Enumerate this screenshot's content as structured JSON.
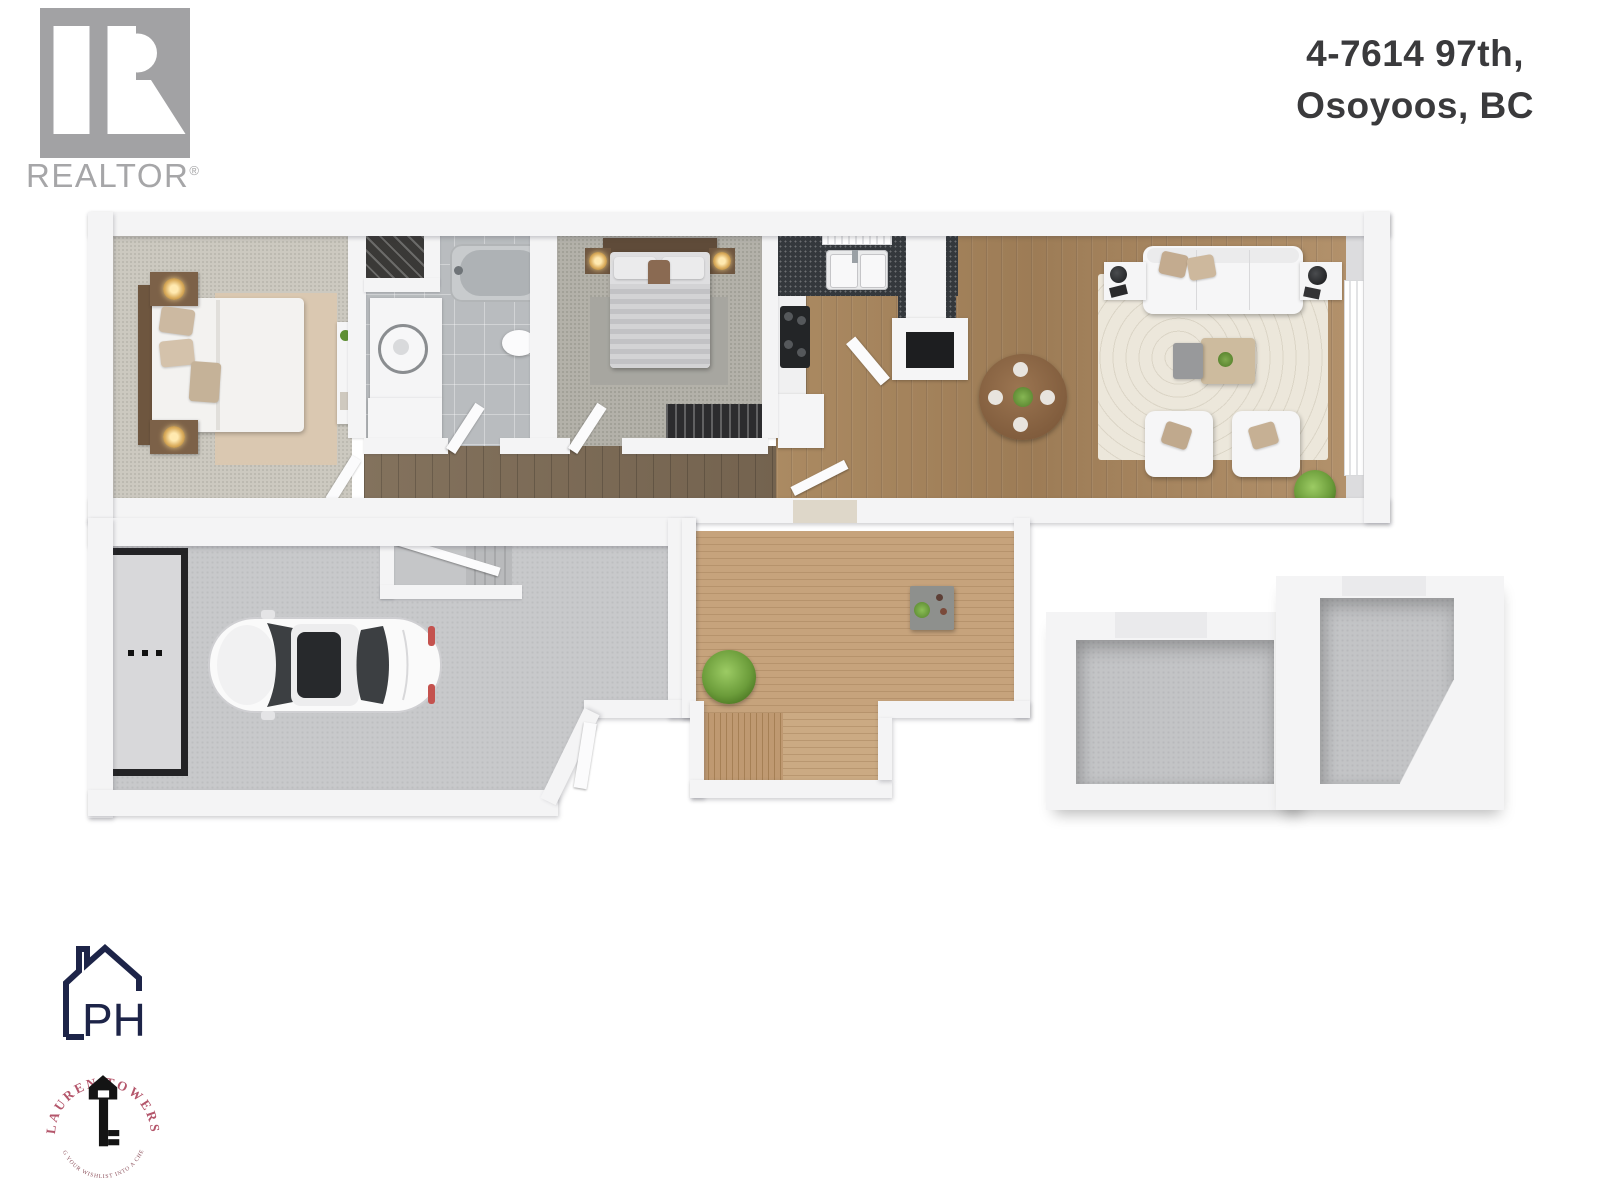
{
  "page": {
    "type": "real-estate-floor-plan-render",
    "background_color": "#ffffff"
  },
  "address": {
    "line1": "4-7614 97th,",
    "line2": "Osoyoos, BC",
    "color": "#3a3a3c"
  },
  "branding": {
    "realtor": {
      "wordmark": "REALTOR",
      "registered_mark": "®",
      "logo_color": "#a2a2a4"
    },
    "ph": {
      "monogram": "PH",
      "color": "#1d2448"
    },
    "lauren_towers": {
      "name": "LAUREN TOWERS",
      "tagline": "TURNING YOUR WISHLIST INTO A CHECKLIST",
      "name_color": "#b4566b",
      "key_color": "#141414"
    }
  },
  "floor_plan": {
    "style": "3d-top-down-render",
    "rooms": [
      "master-bedroom",
      "bathroom",
      "closet",
      "second-bedroom",
      "hallway",
      "kitchen",
      "dining-area",
      "living-room",
      "garage",
      "interior-stairs",
      "deck",
      "deck-stairs",
      "storage-room-1",
      "storage-room-2"
    ],
    "colors": {
      "wall": "#f4f4f5",
      "wood_floor": "#a8875f",
      "hallway_wood": "#7d6c58",
      "deck_wood": "#c2a17b",
      "carpet_master": "#ccc9c0",
      "carpet_bedroom2": "#b3b1a9",
      "bathroom_tile": "#b9bcbf",
      "garage_concrete": "#c8c9cb",
      "living_rug": "#ece7db",
      "master_rug": "#dac8b1",
      "counter_granite": "#34383c"
    }
  }
}
